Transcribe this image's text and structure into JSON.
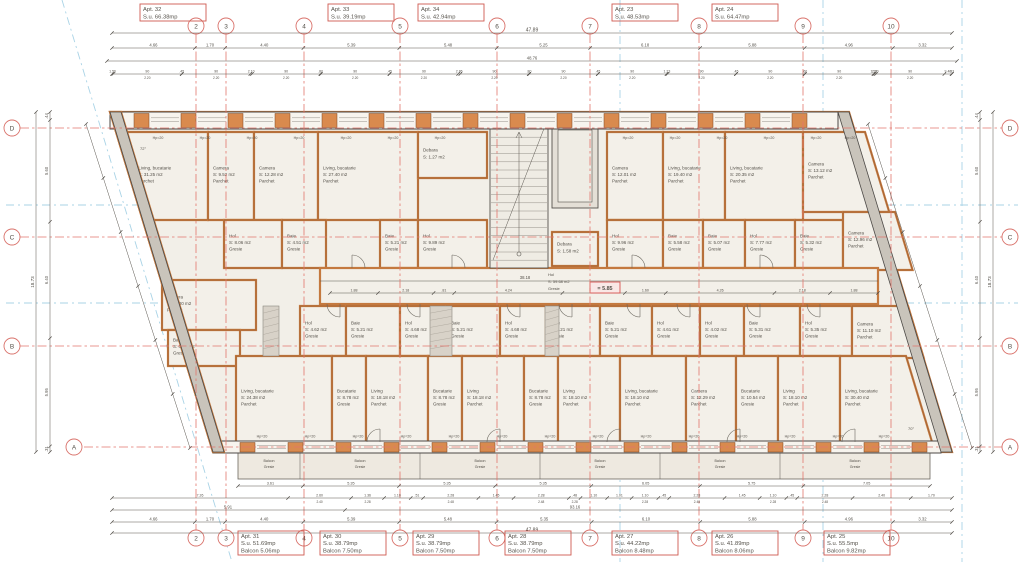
{
  "plan": {
    "level_marker": "= 5.85",
    "grid_cols": [
      {
        "label": "2",
        "x": 196
      },
      {
        "label": "3",
        "x": 226
      },
      {
        "label": "4",
        "x": 304
      },
      {
        "label": "5",
        "x": 400
      },
      {
        "label": "6",
        "x": 497
      },
      {
        "label": "7",
        "x": 590
      },
      {
        "label": "8",
        "x": 699
      },
      {
        "label": "9",
        "x": 803
      },
      {
        "label": "10",
        "x": 891
      }
    ],
    "grid_rows": [
      {
        "label": "D",
        "y": 128
      },
      {
        "label": "C",
        "y": 237
      },
      {
        "label": "B",
        "y": 346
      },
      {
        "label": "A",
        "y": 447
      }
    ],
    "apartments_top": [
      {
        "x": 140,
        "lines": [
          "Apt. 32",
          "S.u. 66.38mp"
        ]
      },
      {
        "x": 328,
        "lines": [
          "Apt. 33",
          "S.u. 39.19mp"
        ]
      },
      {
        "x": 418,
        "lines": [
          "Apt. 34",
          "S.u. 42.94mp"
        ]
      },
      {
        "x": 612,
        "lines": [
          "Apt. 23",
          "S.u. 48.53mp"
        ]
      },
      {
        "x": 712,
        "lines": [
          "Apt. 24",
          "S.u. 64.47mp"
        ]
      }
    ],
    "apartments_bottom": [
      {
        "x": 238,
        "lines": [
          "Apt. 31",
          "S.u. 51.69mp",
          "Balcon 5.06mp"
        ]
      },
      {
        "x": 320,
        "lines": [
          "Apt. 30",
          "S.u. 38.79mp",
          "Balcon 7.50mp"
        ]
      },
      {
        "x": 413,
        "lines": [
          "Apt. 29",
          "S.u. 38.79mp",
          "Balcon 7.50mp"
        ]
      },
      {
        "x": 505,
        "lines": [
          "Apt. 28",
          "S.u. 38.79mp",
          "Balcon 7.50mp"
        ]
      },
      {
        "x": 612,
        "lines": [
          "Apt. 27",
          "S.u. 44.22mp",
          "Balcon 8.48mp"
        ]
      },
      {
        "x": 712,
        "lines": [
          "Apt. 26",
          "S.u. 41.89mp",
          "Balcon 8.06mp"
        ]
      },
      {
        "x": 824,
        "lines": [
          "Apt. 25",
          "S.u. 55.5mp",
          "Balcon 9.82mp"
        ]
      }
    ],
    "rooms": [
      {
        "x": 120,
        "y": 132,
        "w": 88,
        "h": 88,
        "skew": "left",
        "lines": [
          "Living, bucatarie",
          "S: 31.25 m2",
          "Parchet"
        ]
      },
      {
        "x": 208,
        "y": 132,
        "w": 46,
        "h": 88,
        "lines": [
          "Camera",
          "S: 9.52 m2",
          "Parchet"
        ]
      },
      {
        "x": 254,
        "y": 132,
        "w": 64,
        "h": 88,
        "lines": [
          "Camera",
          "S: 12.28 m2",
          "Parchet"
        ]
      },
      {
        "x": 318,
        "y": 132,
        "w": 100,
        "h": 88,
        "lines": [
          "Living, bucatarie",
          "S: 27.40 m2",
          "Parchet"
        ]
      },
      {
        "x": 418,
        "y": 132,
        "w": 69,
        "h": 46,
        "lines": [
          "Debara",
          "S: 1.27 m2"
        ]
      },
      {
        "x": 607,
        "y": 132,
        "w": 56,
        "h": 88,
        "lines": [
          "Camera",
          "S: 12.01 m2",
          "Parchet"
        ]
      },
      {
        "x": 663,
        "y": 132,
        "w": 62,
        "h": 88,
        "lines": [
          "Living, bucatarie",
          "S: 19.40 m2",
          "Parchet"
        ]
      },
      {
        "x": 725,
        "y": 132,
        "w": 78,
        "h": 88,
        "lines": [
          "Living, bucatarie",
          "S: 20.35 m2",
          "Parchet"
        ]
      },
      {
        "x": 803,
        "y": 132,
        "w": 62,
        "h": 80,
        "skew": "right",
        "lines": [
          "Camera",
          "S: 13.12 m2",
          "Parchet"
        ]
      },
      {
        "x": 224,
        "y": 220,
        "w": 58,
        "h": 48,
        "lines": [
          "Hol",
          "S: 8.06 m2",
          "Gresie"
        ]
      },
      {
        "x": 282,
        "y": 220,
        "w": 44,
        "h": 48,
        "lines": [
          "Baie",
          "S: 4.51 m2",
          "Gresie"
        ]
      },
      {
        "x": 380,
        "y": 220,
        "w": 38,
        "h": 48,
        "lines": [
          "Baie",
          "S: 5.21 m2",
          "Gresie"
        ]
      },
      {
        "x": 418,
        "y": 220,
        "w": 69,
        "h": 48,
        "lines": [
          "Hol",
          "S: 9.89 m2",
          "Gresie"
        ]
      },
      {
        "x": 607,
        "y": 220,
        "w": 56,
        "h": 48,
        "lines": [
          "Hol",
          "S: 9.96 m2",
          "Gresie"
        ]
      },
      {
        "x": 663,
        "y": 220,
        "w": 40,
        "h": 48,
        "lines": [
          "Baie",
          "S: 5.58 m2",
          "Gresie"
        ]
      },
      {
        "x": 703,
        "y": 220,
        "w": 42,
        "h": 48,
        "lines": [
          "Baie",
          "S: 5.07 m2",
          "Gresie"
        ]
      },
      {
        "x": 745,
        "y": 220,
        "w": 50,
        "h": 48,
        "lines": [
          "Hol",
          "S: 7.77 m2",
          "Gresie"
        ]
      },
      {
        "x": 795,
        "y": 220,
        "w": 48,
        "h": 48,
        "lines": [
          "Baie",
          "S: 5.32 m2",
          "Gresie"
        ]
      },
      {
        "x": 843,
        "y": 212,
        "w": 52,
        "h": 58,
        "skew": "right",
        "lines": [
          "Camera",
          "S: 12.96 m2",
          "Parchet"
        ]
      },
      {
        "x": 552,
        "y": 232,
        "w": 46,
        "h": 34,
        "lines": [
          "Debara",
          "S: 1.58 m2"
        ]
      },
      {
        "x": 162,
        "y": 280,
        "w": 94,
        "h": 50,
        "lines": [
          "Camera",
          "S: 14.00 m2",
          "Parchet"
        ]
      },
      {
        "x": 168,
        "y": 330,
        "w": 72,
        "h": 36,
        "lines": [
          "Baie",
          "S: 6.89 m2",
          "Gresie"
        ]
      },
      {
        "x": 300,
        "y": 306,
        "w": 46,
        "h": 50,
        "lines": [
          "Hol",
          "S: 4.62 m2",
          "Gresie"
        ]
      },
      {
        "x": 346,
        "y": 306,
        "w": 54,
        "h": 50,
        "lines": [
          "Baie",
          "S: 5.21 m2",
          "Gresie"
        ]
      },
      {
        "x": 400,
        "y": 306,
        "w": 46,
        "h": 50,
        "lines": [
          "Hol",
          "S: 4.68 m2",
          "Gresie"
        ]
      },
      {
        "x": 446,
        "y": 306,
        "w": 54,
        "h": 50,
        "lines": [
          "Baie",
          "S: 5.21 m2",
          "Gresie"
        ]
      },
      {
        "x": 500,
        "y": 306,
        "w": 46,
        "h": 50,
        "lines": [
          "Hol",
          "S: 4.68 m2",
          "Gresie"
        ]
      },
      {
        "x": 546,
        "y": 306,
        "w": 54,
        "h": 50,
        "lines": [
          "Baie",
          "S: 5.21 m2",
          "Gresie"
        ]
      },
      {
        "x": 600,
        "y": 306,
        "w": 52,
        "h": 50,
        "lines": [
          "Baie",
          "S: 5.21 m2",
          "Gresie"
        ]
      },
      {
        "x": 652,
        "y": 306,
        "w": 48,
        "h": 50,
        "lines": [
          "Hol",
          "S: 4.61 m2",
          "Gresie"
        ]
      },
      {
        "x": 700,
        "y": 306,
        "w": 44,
        "h": 50,
        "lines": [
          "Hol",
          "S: 4.02 m2",
          "Gresie"
        ]
      },
      {
        "x": 744,
        "y": 306,
        "w": 56,
        "h": 50,
        "lines": [
          "Baie",
          "S: 5.31 m2",
          "Gresie"
        ]
      },
      {
        "x": 800,
        "y": 306,
        "w": 52,
        "h": 50,
        "lines": [
          "Hol",
          "S: 5.35 m2",
          "Gresie"
        ]
      },
      {
        "x": 852,
        "y": 306,
        "w": 56,
        "h": 52,
        "skew": "right",
        "lines": [
          "Camera",
          "S: 11.10 m2",
          "Parchet"
        ]
      },
      {
        "x": 236,
        "y": 356,
        "w": 96,
        "h": 86,
        "lines": [
          "Living, bucatarie",
          "S: 24.38 m2",
          "Parchet"
        ]
      },
      {
        "x": 332,
        "y": 356,
        "w": 34,
        "h": 86,
        "lines": [
          "Bucatarie",
          "S: 8.78 m2",
          "Gresie"
        ]
      },
      {
        "x": 366,
        "y": 356,
        "w": 62,
        "h": 86,
        "lines": [
          "Living",
          "S: 18.18 m2",
          "Parchet"
        ]
      },
      {
        "x": 428,
        "y": 356,
        "w": 34,
        "h": 86,
        "lines": [
          "Bucatarie",
          "S: 8.78 m2",
          "Gresie"
        ]
      },
      {
        "x": 462,
        "y": 356,
        "w": 62,
        "h": 86,
        "lines": [
          "Living",
          "S: 18.18 m2",
          "Parchet"
        ]
      },
      {
        "x": 524,
        "y": 356,
        "w": 34,
        "h": 86,
        "lines": [
          "Bucatarie",
          "S: 8.78 m2",
          "Gresie"
        ]
      },
      {
        "x": 558,
        "y": 356,
        "w": 62,
        "h": 86,
        "lines": [
          "Living",
          "S: 18.10 m2",
          "Parchet"
        ]
      },
      {
        "x": 620,
        "y": 356,
        "w": 66,
        "h": 86,
        "lines": [
          "Living, bucatarie",
          "S: 18.10 m2",
          "Parchet"
        ]
      },
      {
        "x": 686,
        "y": 356,
        "w": 50,
        "h": 86,
        "lines": [
          "Camera",
          "S: 12.29 m2",
          "Parchet"
        ]
      },
      {
        "x": 736,
        "y": 356,
        "w": 42,
        "h": 86,
        "lines": [
          "Bucatarie",
          "S: 10.54 m2",
          "Gresie"
        ]
      },
      {
        "x": 778,
        "y": 356,
        "w": 62,
        "h": 86,
        "lines": [
          "Living",
          "S: 18.10 m2",
          "Parchet"
        ]
      },
      {
        "x": 840,
        "y": 356,
        "w": 66,
        "h": 86,
        "skew": "right",
        "lines": [
          "Living, bucatarie",
          "S: 30.40 m2",
          "Parchet"
        ]
      }
    ],
    "corridor": {
      "label": [
        "Hol",
        "S: 59.68 m2",
        "Gresie"
      ],
      "span_dim": "38.18",
      "chain": [
        "1.88",
        "2.18",
        ".81",
        "4.24",
        "2.45",
        "1.60",
        "4.26",
        "2.18",
        "1.88"
      ]
    },
    "balcony": {
      "label": [
        "Balcon",
        "Gresie"
      ],
      "dividers": [
        300,
        420,
        540,
        660,
        780
      ]
    },
    "window_label": "Hp=20",
    "window_label_top_x": [
      158,
      205,
      252,
      299,
      346,
      393,
      440,
      628,
      675,
      722,
      769,
      816,
      850
    ],
    "window_label_bottom_x": [
      262,
      310,
      358,
      406,
      454,
      502,
      550,
      598,
      646,
      694,
      742,
      790,
      838,
      884
    ],
    "dim_rows": {
      "top_total": [
        "47.89"
      ],
      "top_axes": [
        "4.66",
        "1.70",
        "4.40",
        "5.39",
        "5.48",
        "5.25",
        "6.18",
        "5.88",
        "4.96",
        "3.32"
      ],
      "top_overall2": [
        "48.76"
      ],
      "top_small": [
        "1.56",
        "90|2.20",
        ".45",
        "90|2.20",
        "2.10",
        "90|2.20",
        ".80",
        "90|2.20",
        ".45",
        "90|2.20",
        "2.86",
        "90|2.20",
        ".80",
        "90|2.20",
        ".45",
        "90|2.20",
        "1.23",
        "90|2.20",
        ".45",
        "90|2.20",
        ".60",
        "90|2.20",
        "1.24",
        "2.10",
        "90|2.20",
        "9.40",
        ".63"
      ],
      "balcony_row": [
        "3.61",
        "5.35",
        "5.35",
        "5.35",
        "6.05",
        "5.75",
        "7.05"
      ],
      "bottom_small": [
        "7.26",
        "2.60|2.40",
        "1.36|2.28",
        "1.10",
        ".51",
        "2.28|2.48",
        "1.45",
        "2.28|2.48",
        ".48|2.28",
        "1.10",
        "1.01",
        "1.10|2.28",
        ".45",
        "2.28|2.48",
        "1.45",
        "1.10|2.28",
        ".45",
        "2.28|2.48",
        "2.40",
        "1.70"
      ],
      "bottom_mid_left": "5.91",
      "bottom_mid_total": "93.16",
      "bottom_axes": [
        "4.66",
        "1.70",
        "4.40",
        "5.39",
        "5.48",
        "5.35",
        "6.10",
        "5.88",
        "4.96",
        "3.32"
      ],
      "bottom_total": [
        "47.89"
      ],
      "side_axes": [
        ".44",
        "5.60",
        "6.40",
        "5.95",
        ".31"
      ],
      "side_total": [
        "18.73"
      ]
    },
    "angle_labels": [
      {
        "x": 140,
        "y": 150,
        "t": "72°"
      },
      {
        "x": 908,
        "y": 430,
        "t": "70°"
      }
    ]
  }
}
